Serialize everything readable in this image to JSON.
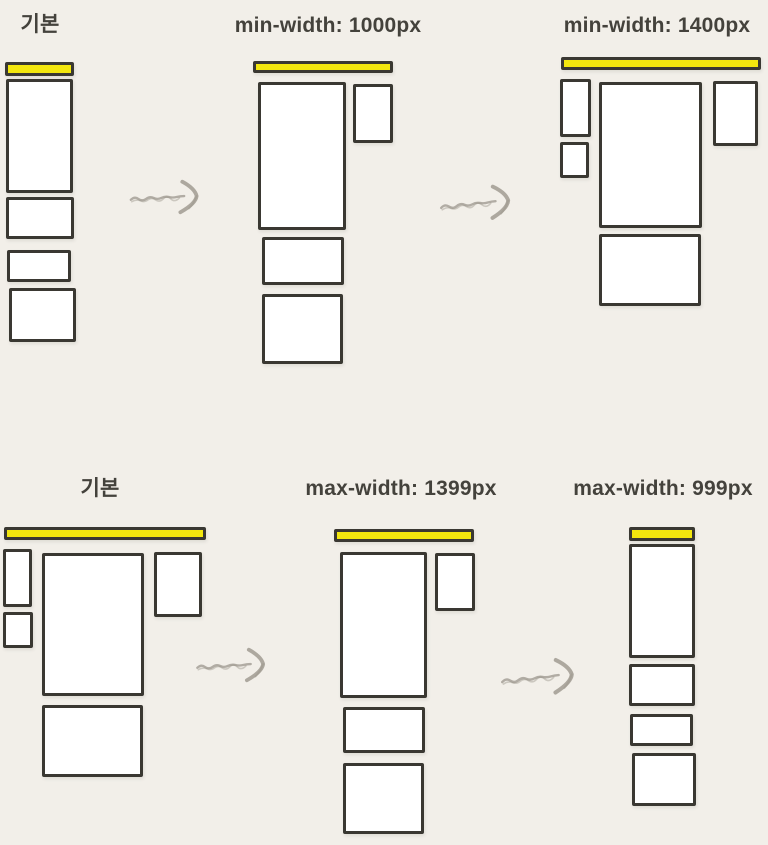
{
  "canvas": {
    "width": 768,
    "height": 845,
    "background": "#f2efe9"
  },
  "colors": {
    "accent_yellow": "#f3e70e",
    "box_border": "#3a3832",
    "box_fill": "#ffffff",
    "title_text": "#44423c",
    "arrow": "#9b968c"
  },
  "rows": [
    {
      "name": "min-width-demo",
      "panels": [
        {
          "id": "basic-top",
          "title": "기본",
          "title_center_x": 40,
          "title_top": 12,
          "header_bar": {
            "x": 5,
            "y": 62,
            "w": 69,
            "h": 14
          },
          "blocks": [
            {
              "x": 6,
              "y": 79,
              "w": 67,
              "h": 114
            },
            {
              "x": 6,
              "y": 197,
              "w": 68,
              "h": 42
            },
            {
              "x": 7,
              "y": 250,
              "w": 64,
              "h": 32
            },
            {
              "x": 9,
              "y": 288,
              "w": 67,
              "h": 54
            }
          ]
        },
        {
          "id": "min-1000",
          "title": "min-width: 1000px",
          "title_center_x": 328,
          "title_top": 13,
          "header_bar": {
            "x": 253,
            "y": 61,
            "w": 140,
            "h": 12
          },
          "blocks": [
            {
              "x": 258,
              "y": 82,
              "w": 88,
              "h": 148
            },
            {
              "x": 353,
              "y": 84,
              "w": 40,
              "h": 59
            },
            {
              "x": 262,
              "y": 237,
              "w": 82,
              "h": 48
            },
            {
              "x": 262,
              "y": 294,
              "w": 81,
              "h": 70
            }
          ]
        },
        {
          "id": "min-1400",
          "title": "min-width: 1400px",
          "title_center_x": 657,
          "title_top": 13,
          "header_bar": {
            "x": 561,
            "y": 57,
            "w": 200,
            "h": 13
          },
          "blocks": [
            {
              "x": 560,
              "y": 79,
              "w": 31,
              "h": 58
            },
            {
              "x": 560,
              "y": 142,
              "w": 29,
              "h": 36
            },
            {
              "x": 599,
              "y": 82,
              "w": 103,
              "h": 146
            },
            {
              "x": 713,
              "y": 81,
              "w": 45,
              "h": 65
            },
            {
              "x": 599,
              "y": 234,
              "w": 102,
              "h": 72
            }
          ]
        }
      ]
    },
    {
      "name": "max-width-demo",
      "panels": [
        {
          "id": "basic-bottom",
          "title": "기본",
          "title_center_x": 100,
          "title_top": 476,
          "header_bar": {
            "x": 4,
            "y": 527,
            "w": 202,
            "h": 13
          },
          "blocks": [
            {
              "x": 3,
              "y": 549,
              "w": 29,
              "h": 58
            },
            {
              "x": 3,
              "y": 612,
              "w": 30,
              "h": 36
            },
            {
              "x": 42,
              "y": 553,
              "w": 102,
              "h": 143
            },
            {
              "x": 154,
              "y": 552,
              "w": 48,
              "h": 65
            },
            {
              "x": 42,
              "y": 705,
              "w": 101,
              "h": 72
            }
          ]
        },
        {
          "id": "max-1399",
          "title": "max-width: 1399px",
          "title_center_x": 401,
          "title_top": 476,
          "header_bar": {
            "x": 334,
            "y": 529,
            "w": 140,
            "h": 13
          },
          "blocks": [
            {
              "x": 340,
              "y": 552,
              "w": 87,
              "h": 146
            },
            {
              "x": 435,
              "y": 553,
              "w": 40,
              "h": 58
            },
            {
              "x": 343,
              "y": 707,
              "w": 82,
              "h": 46
            },
            {
              "x": 343,
              "y": 763,
              "w": 81,
              "h": 71
            }
          ]
        },
        {
          "id": "max-999",
          "title": "max-width: 999px",
          "title_center_x": 663,
          "title_top": 476,
          "header_bar": {
            "x": 629,
            "y": 527,
            "w": 66,
            "h": 14
          },
          "blocks": [
            {
              "x": 629,
              "y": 544,
              "w": 66,
              "h": 114
            },
            {
              "x": 629,
              "y": 664,
              "w": 66,
              "h": 42
            },
            {
              "x": 630,
              "y": 714,
              "w": 63,
              "h": 32
            },
            {
              "x": 632,
              "y": 753,
              "w": 64,
              "h": 53
            }
          ]
        }
      ]
    }
  ]
}
